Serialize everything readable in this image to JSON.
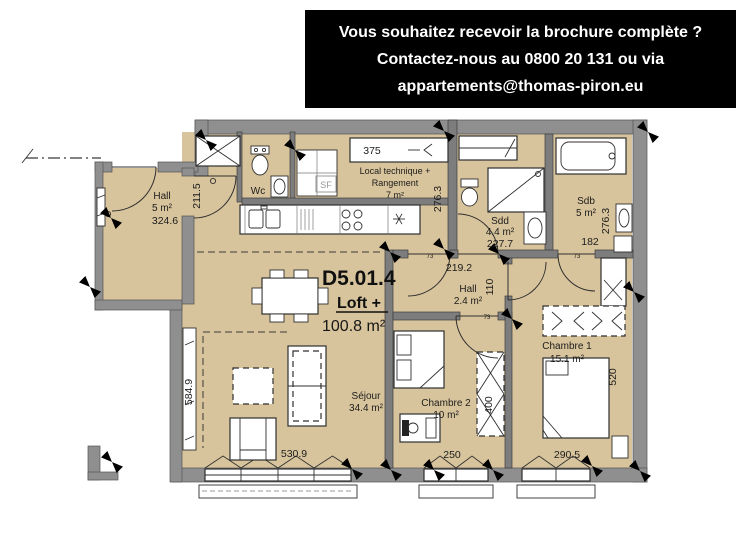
{
  "banner": {
    "line1": "Vous souhaitez recevoir la brochure complète ?",
    "line2": "Contactez-nous au 0800 20 131 ou via",
    "line3": "appartements@thomas-piron.eu"
  },
  "unit": {
    "code": "D5.01.4",
    "type_label": "Loft +",
    "total_area": "100.8 m²"
  },
  "rooms": {
    "entrance_hall": {
      "name": "Hall",
      "area": "5 m²"
    },
    "wc": {
      "name": "Wc"
    },
    "technical": {
      "line1": "Local technique +",
      "line2": "Rangement",
      "area": "7 m²"
    },
    "shower_room": {
      "name": "Sdd",
      "area": "4.4 m²"
    },
    "bathroom": {
      "name": "Sdb",
      "area": "5 m²"
    },
    "inner_hall": {
      "name": "Hall",
      "area": "2.4 m²"
    },
    "living_room": {
      "name": "Séjour",
      "area": "34.4 m²"
    },
    "bedroom_2": {
      "name": "Chambre 2",
      "area": "10 m²"
    },
    "bedroom_1": {
      "name": "Chambre 1",
      "area": "15.1 m²"
    }
  },
  "dimensions": {
    "entrance_hall_width": "324.6",
    "entrance_hall_depth": "211.5",
    "technical_closet_width": "375",
    "technical_depth": "276.3",
    "shower_room_width": "227.7",
    "bathroom_width": "182",
    "bathroom_depth": "276.3",
    "inner_hall_width": "219.2",
    "inner_hall_depth": "110",
    "living_room_depth": "584.9",
    "living_room_width": "530.9",
    "bedroom_2_width": "250",
    "bedroom_2_wardrobe_width": "400",
    "bedroom_1_width": "290.5",
    "bedroom_1_depth": "520",
    "door_width_a": "73",
    "door_width_b": "73",
    "door_width_c": "73"
  },
  "annotations": {
    "ventilation_label": "SF"
  },
  "colors": {
    "floor": "#d8c49c",
    "wall": "#8f8f8f",
    "line": "#2f2f2f",
    "banner_background": "#000000",
    "banner_text": "#ffffff"
  }
}
